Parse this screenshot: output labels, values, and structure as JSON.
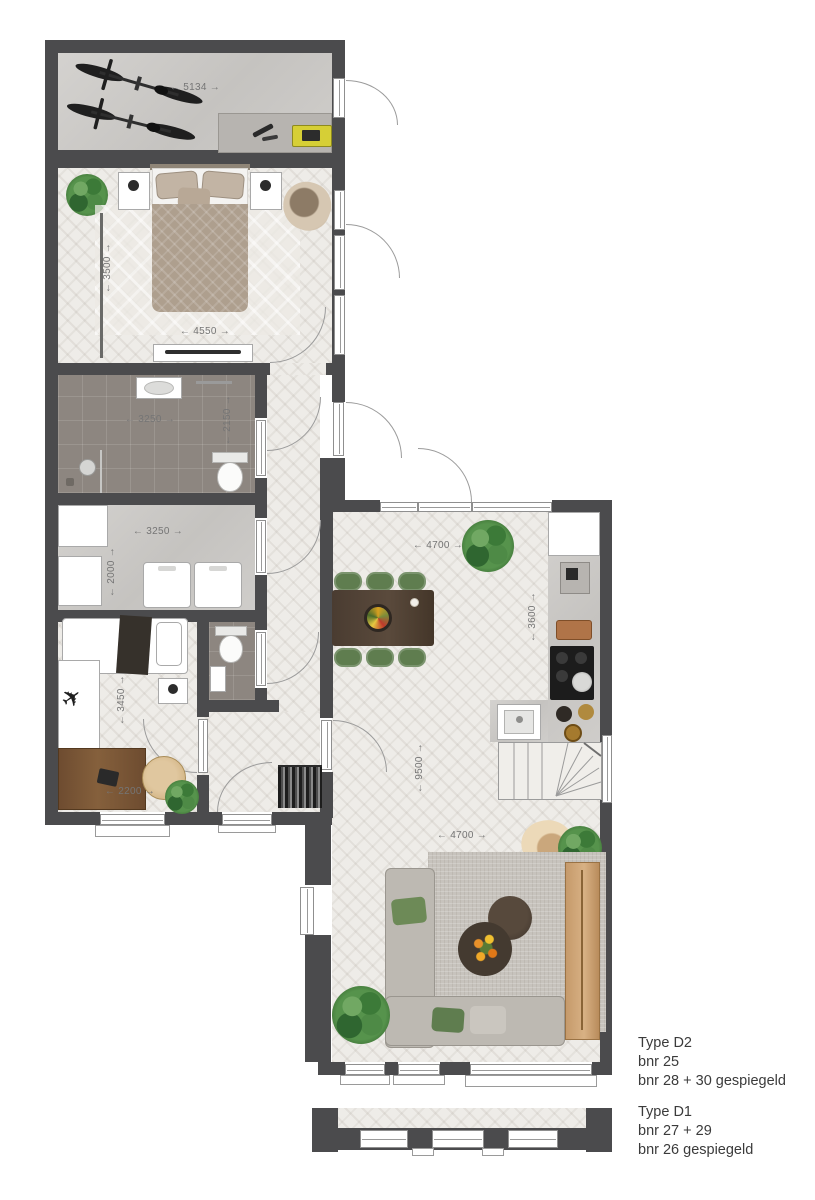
{
  "legend": {
    "d2": {
      "title": "Type D2",
      "lines": [
        "bnr 25",
        "bnr 28 + 30 gespiegeld"
      ]
    },
    "d1": {
      "title": "Type D1",
      "lines": [
        "bnr 27 + 29",
        "bnr 26 gespiegeld"
      ]
    }
  },
  "dimensions": {
    "storage_width": "← 5134 →",
    "bedroom1_depth": "← 3500 →",
    "bedroom1_width": "← 4550 →",
    "bathroom_width": "← 3250 →",
    "bathroom_depth": "← 2150 →",
    "utility_width": "← 3250 →",
    "utility_depth": "← 2000 →",
    "bedroom2_depth": "← 3450 →",
    "bedroom2_width": "← 2200 →",
    "living_top_width": "← 4700 →",
    "kitchen_depth": "← 3600 →",
    "living_length": "← 9500 →",
    "living_width": "← 4700 →"
  },
  "colors": {
    "wall": "#4b4b4d",
    "floor_wood": "#eeece8",
    "floor_concrete": "#cdcbc8",
    "floor_tile": "#8d8680",
    "chair_green": "#5f7d4f",
    "desk_wood": "#7a5636",
    "cabinet_wood": "#c59a6b",
    "sofa_gray": "#bdb9b2",
    "armchair_tan": "#d2bfa5",
    "toolbox_yellow": "#d6cf36",
    "dim_text": "#757575",
    "legend_text": "#3b3b3b"
  }
}
